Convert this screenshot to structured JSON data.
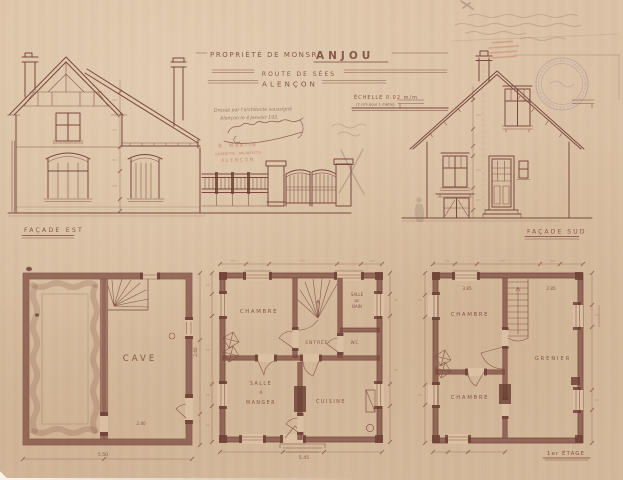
{
  "title_block": {
    "property_prefix": "PROPRIÉTÉ DE MONSR",
    "property_name": "ANJOU",
    "street_line": "ROUTE DE SÉES",
    "city_line": "ALENÇON",
    "scale_line": "ÉCHELLE 0.02 m/m",
    "scale_subline": "(2 c/m pour 1 mètre)",
    "drafted_note_line1": "Dressé par l'architecte soussigné",
    "drafted_note_line2": "Alençon le 4 Janvier 193.",
    "architect_stamp": {
      "line1": "R. MARTIN",
      "line2": "GÉOMÈTRE · ARCHITECTE",
      "line3": "ALENÇON"
    }
  },
  "elevations": {
    "left_caption": "FAÇADE EST",
    "right_caption": "FAÇADE SUD"
  },
  "plans": {
    "basement": {
      "cave": "CAVE",
      "dim_width": "5.50",
      "dim_inner": "2.40",
      "dim_right": "2.60"
    },
    "ground": {
      "chambre": "CHAMBRE",
      "salle_de_bain": [
        "SALLE",
        "DE",
        "BAIN"
      ],
      "entree": "ENTRÉE",
      "wc": "W.C.",
      "salle_a_manger": [
        "SALLE",
        "À",
        "MANGER"
      ],
      "cuisine": "CUISINE",
      "dim_width": "5.45"
    },
    "first": {
      "caption": "1er ÉTAGE",
      "chambre_top": "CHAMBRE",
      "grenier": "GRENIER",
      "chambre_bottom": "CHAMBRE",
      "dim_left": "3.85",
      "dim_right": "2.85"
    }
  },
  "colors": {
    "paper": "#d9bfa3",
    "ink": "#7b4a3e",
    "stamp_red": "#b5483a",
    "seal_blue": "#7a6d96",
    "pencil": "#8f7d6a"
  }
}
